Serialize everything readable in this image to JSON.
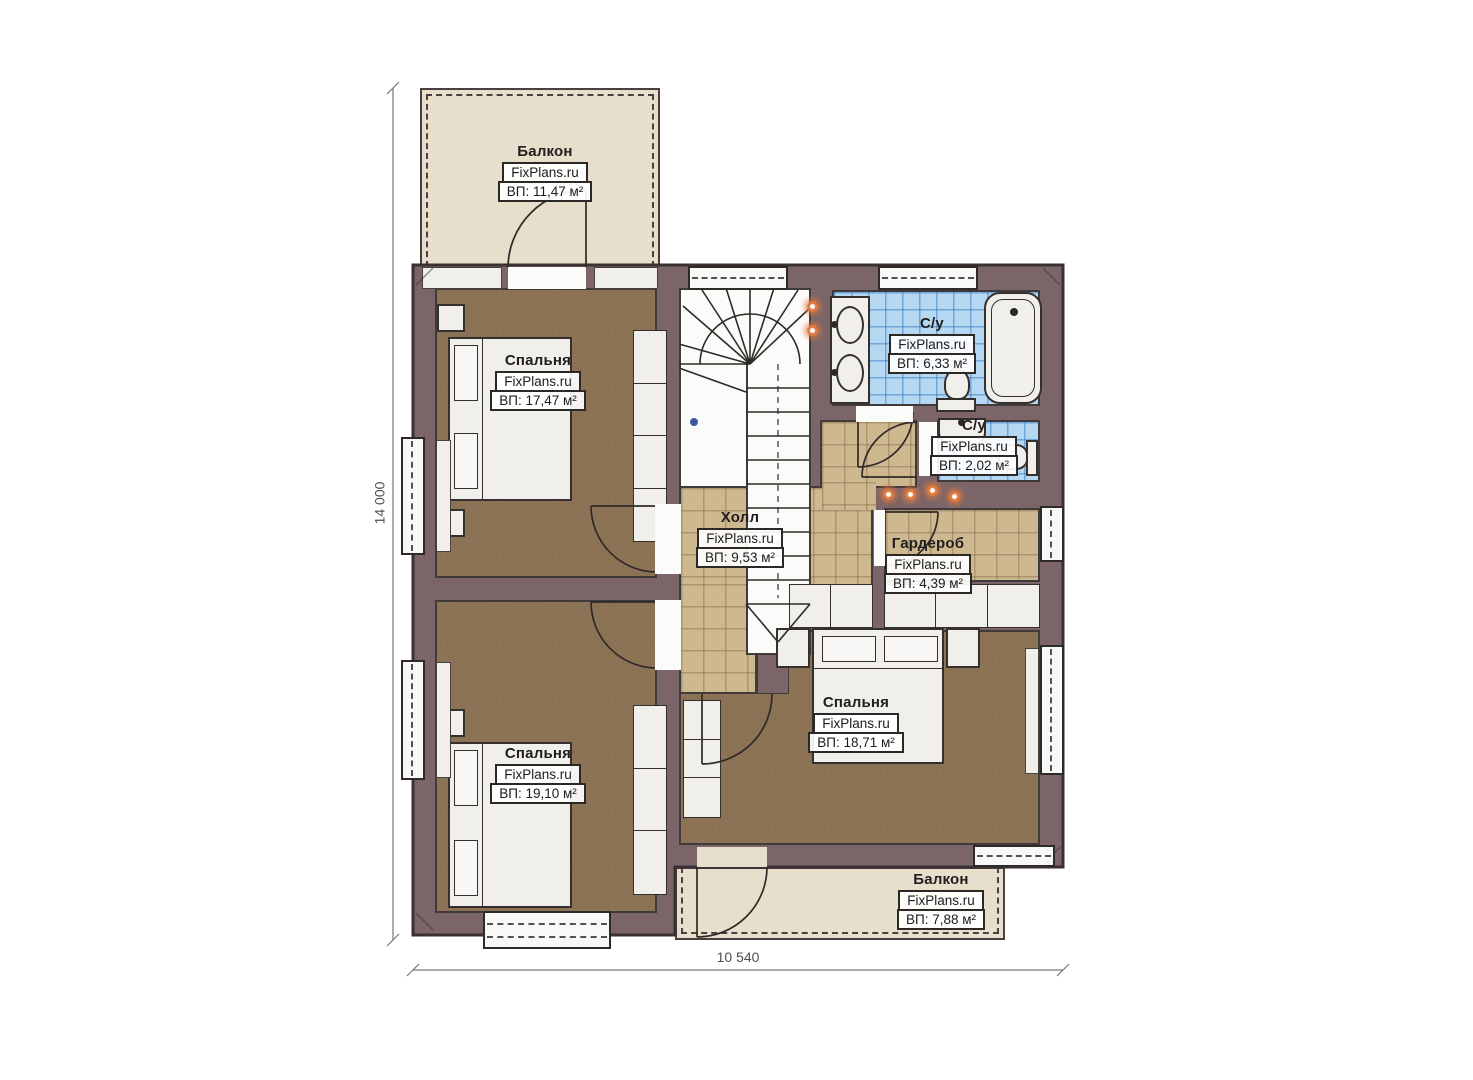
{
  "page": {
    "background": "#ffffff"
  },
  "plan": {
    "dimensions": {
      "height_label": "14 000",
      "width_label": "10 540"
    },
    "rooms": {
      "balcony_top": {
        "name": "Балкон",
        "brand": "FixPlans.ru",
        "area": "ВП: 11,47 м²"
      },
      "bedroom_top_left": {
        "name": "Спальня",
        "brand": "FixPlans.ru",
        "area": "ВП: 17,47 м²"
      },
      "bathroom_main": {
        "name": "С/у",
        "brand": "FixPlans.ru",
        "area": "ВП: 6,33 м²"
      },
      "bathroom_small": {
        "name": "С/у",
        "brand": "FixPlans.ru",
        "area": "ВП: 2,02 м²"
      },
      "hall": {
        "name": "Холл",
        "brand": "FixPlans.ru",
        "area": "ВП: 9,53 м²"
      },
      "wardrobe": {
        "name": "Гардероб",
        "brand": "FixPlans.ru",
        "area": "ВП: 4,39 м²"
      },
      "bedroom_right": {
        "name": "Спальня",
        "brand": "FixPlans.ru",
        "area": "ВП: 18,71 м²"
      },
      "bedroom_bottom_left": {
        "name": "Спальня",
        "brand": "FixPlans.ru",
        "area": "ВП: 19,10 м²"
      },
      "balcony_bottom": {
        "name": "Балкон",
        "brand": "FixPlans.ru",
        "area": "ВП: 7,88 м²"
      }
    },
    "colors": {
      "wall": "#7c6568",
      "floor_wood": "#8c7355",
      "tile_tan": "#cdb88f",
      "tile_blue": "#b5d7f2",
      "balcony": "#e7decb",
      "light_accent": "#e4793f"
    }
  }
}
